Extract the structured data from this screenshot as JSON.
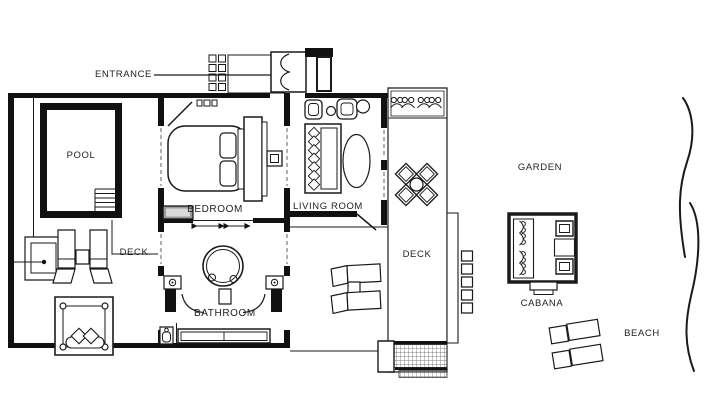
{
  "meta": {
    "description": "Black-and-white architectural floor plan of a beach villa",
    "background": "#ffffff",
    "ink": "#1a1a1a",
    "muted_line": "#8f8f8f",
    "bench_fill": "#9a9a9a"
  },
  "labels": {
    "entrance": "ENTRANCE",
    "pool": "POOL",
    "bedroom": "BEDROOM",
    "living_room": "LIVING ROOM",
    "bathroom": "BATHROOM",
    "deck_left": "DECK",
    "deck_right": "DECK",
    "garden": "GARDEN",
    "cabana": "CABANA",
    "beach": "BEACH"
  }
}
